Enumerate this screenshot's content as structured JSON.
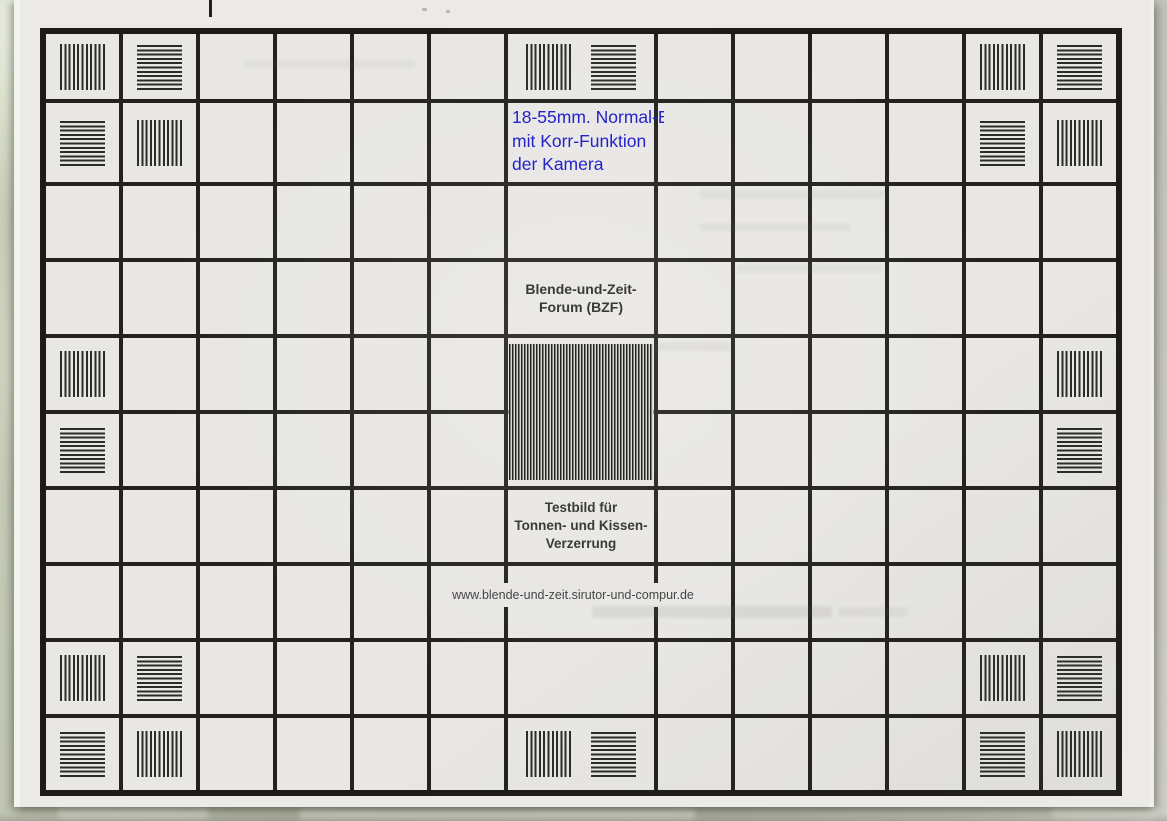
{
  "colors": {
    "background_surface": "#b3b8a6",
    "paper": "#ebeae8",
    "cell": "#e8e7e5",
    "grid_line": "#242220",
    "grid_border": "#1d1b19",
    "patch_stripe": "#2b2b29",
    "block_stripe": "#232321",
    "annotation_blue": "#2323c8",
    "label_dark": "#3b3a38",
    "url_text": "#474645"
  },
  "chart": {
    "grid": {
      "rows": 10,
      "cols": 13,
      "wide_col": 7
    },
    "annotation": {
      "lines": [
        "18-55mm. Normal-Br",
        "mit Korr-Funktion",
        "der Kamera"
      ]
    },
    "forum_title": {
      "lines": [
        "Blende-und-Zeit-",
        "Forum (BZF)"
      ]
    },
    "distortion_label": {
      "lines": [
        "Testbild für",
        "Tonnen- und Kissen-",
        "Verzerrung"
      ]
    },
    "url": "www.blende-und-zeit.sirutor-und-compur.de",
    "patches": [
      {
        "row": 1,
        "col": 1,
        "dir": "v"
      },
      {
        "row": 1,
        "col": 2,
        "dir": "h"
      },
      {
        "row": 1,
        "col": 7,
        "dir": "v"
      },
      {
        "row": 1,
        "col": 7,
        "dir": "h"
      },
      {
        "row": 1,
        "col": 12,
        "dir": "v"
      },
      {
        "row": 1,
        "col": 13,
        "dir": "h"
      },
      {
        "row": 2,
        "col": 1,
        "dir": "h"
      },
      {
        "row": 2,
        "col": 2,
        "dir": "v"
      },
      {
        "row": 2,
        "col": 12,
        "dir": "h"
      },
      {
        "row": 2,
        "col": 13,
        "dir": "v"
      },
      {
        "row": 5,
        "col": 1,
        "dir": "v"
      },
      {
        "row": 5,
        "col": 13,
        "dir": "v"
      },
      {
        "row": 6,
        "col": 1,
        "dir": "h"
      },
      {
        "row": 6,
        "col": 13,
        "dir": "h"
      },
      {
        "row": 9,
        "col": 1,
        "dir": "v"
      },
      {
        "row": 9,
        "col": 2,
        "dir": "h"
      },
      {
        "row": 9,
        "col": 12,
        "dir": "v"
      },
      {
        "row": 9,
        "col": 13,
        "dir": "h"
      },
      {
        "row": 10,
        "col": 1,
        "dir": "h"
      },
      {
        "row": 10,
        "col": 2,
        "dir": "v"
      },
      {
        "row": 10,
        "col": 7,
        "dir": "v"
      },
      {
        "row": 10,
        "col": 7,
        "dir": "h"
      },
      {
        "row": 10,
        "col": 12,
        "dir": "h"
      },
      {
        "row": 10,
        "col": 13,
        "dir": "v"
      }
    ],
    "center_block": {
      "row_start": 5,
      "row_end": 6,
      "col": 7,
      "stripes": "vertical"
    }
  }
}
